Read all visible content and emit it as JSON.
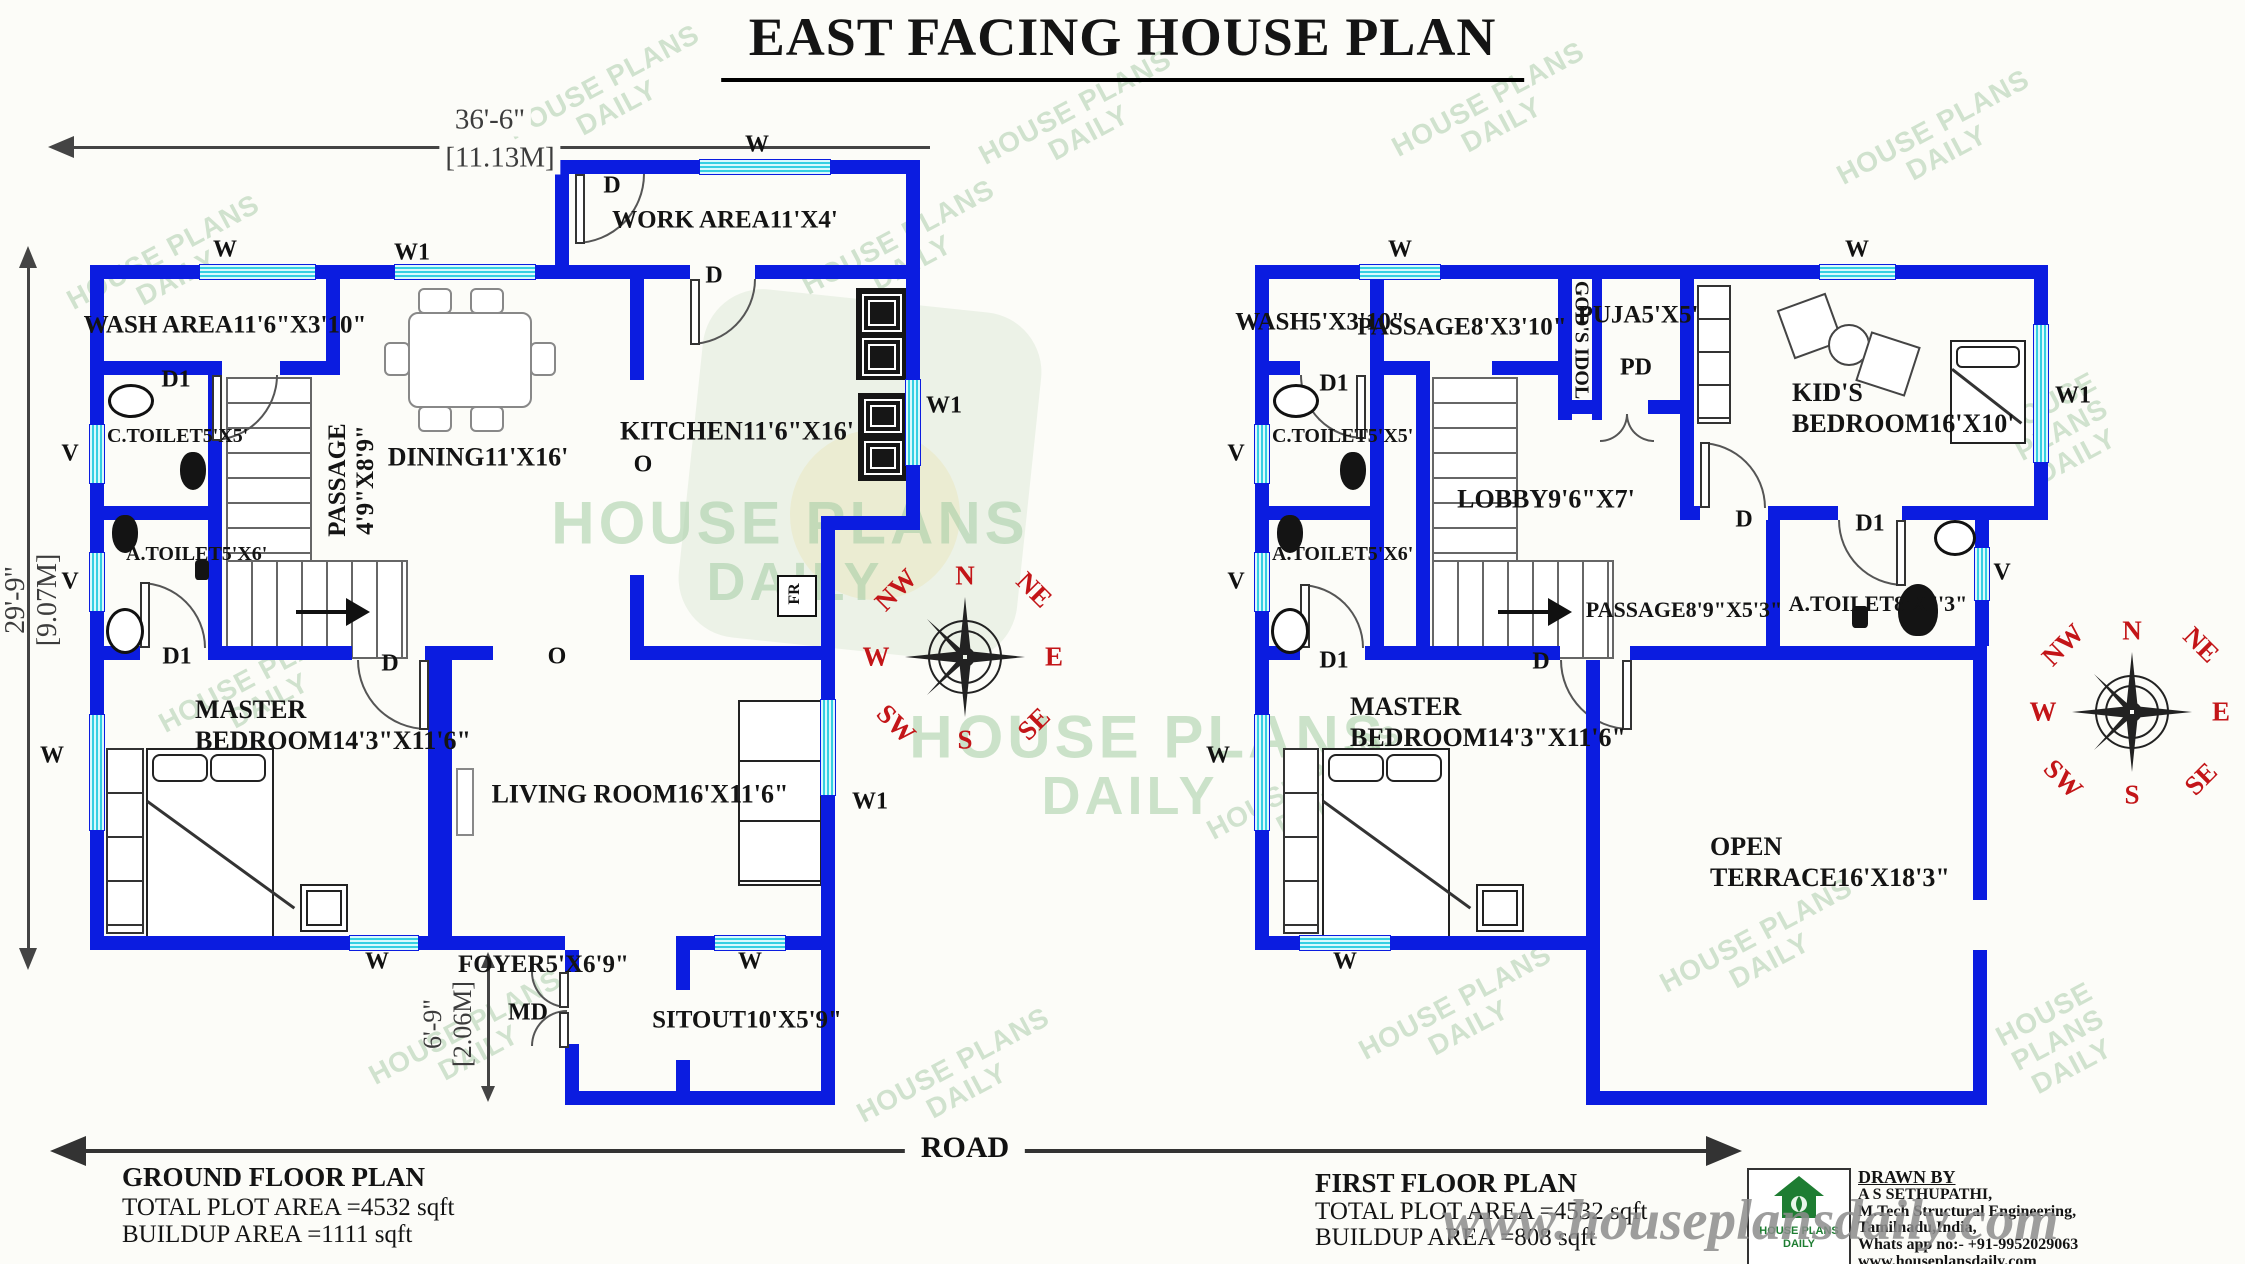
{
  "title": "EAST FACING HOUSE PLAN",
  "road_label": "ROAD",
  "watermark": {
    "site": "www.houseplansdaily.com",
    "brand_line1": "HOUSE PLANS",
    "brand_line2": "DAILY"
  },
  "markers": {
    "window": "W",
    "window1": "W1",
    "door": "D",
    "door1": "D1",
    "vent": "V",
    "opening": "O",
    "main_door": "MD",
    "puja_door": "PD",
    "fridge": "FR"
  },
  "dimensions": {
    "width_ft": "36'-6\"",
    "width_m": "[11.13M]",
    "height_ft": "29'-9\"",
    "height_m": "[9.07M]",
    "foyer_ft": "6'-9\"",
    "foyer_m": "[2.06M]"
  },
  "compass": {
    "n": "N",
    "ne": "NE",
    "e": "E",
    "se": "SE",
    "s": "S",
    "sw": "SW",
    "w": "W",
    "nw": "NW"
  },
  "ground_floor": {
    "rooms": {
      "work_area": {
        "name": "WORK AREA",
        "size": "11'X4'"
      },
      "wash_area": {
        "name": "WASH AREA",
        "size": "11'6\"X3'10\""
      },
      "c_toilet": {
        "name": "C.TOILET",
        "size": "5'X5'"
      },
      "a_toilet": {
        "name": "A.TOILET",
        "size": "5'X6'"
      },
      "passage": {
        "name": "PASSAGE",
        "size": "4'9\"X8'9\""
      },
      "dining": {
        "name": "DINING",
        "size": "11'X16'"
      },
      "kitchen": {
        "name": "KITCHEN",
        "size": "11'6\"X16'"
      },
      "master_bedroom": {
        "name": "MASTER BEDROOM",
        "size": "14'3\"X11'6\""
      },
      "living_room": {
        "name": "LIVING ROOM",
        "size": "16'X11'6\""
      },
      "foyer": {
        "name": "FOYER",
        "size": "5'X6'9\""
      },
      "sitout": {
        "name": "SITOUT",
        "size": "10'X5'9\""
      }
    },
    "footer": {
      "title": "GROUND FLOOR PLAN",
      "plot_area": "TOTAL PLOT AREA =4532 sqft",
      "buildup_area": "BUILDUP AREA =1111 sqft"
    }
  },
  "first_floor": {
    "rooms": {
      "wash": {
        "name": "WASH",
        "size": "5'X3'10\""
      },
      "passage_upper": {
        "name": "PASSAGE",
        "size": "8'X3'10\""
      },
      "gods_idol": {
        "name": "GOD'S IDOL"
      },
      "puja": {
        "name": "PUJA",
        "size": "5'X5'"
      },
      "kids_bedroom": {
        "name": "KID'S BEDROOM",
        "size": "16'X10'"
      },
      "c_toilet": {
        "name": "C.TOILET",
        "size": "5'X5'"
      },
      "a_toilet": {
        "name": "A.TOILET",
        "size": "5'X6'"
      },
      "lobby": {
        "name": "LOBBY",
        "size": "9'6\"X7'"
      },
      "passage_lower": {
        "name": "PASSAGE",
        "size": "8'9\"X5'3\""
      },
      "a_toilet2": {
        "name": "A.TOILET",
        "size": "8'X5'3\""
      },
      "master_bedroom": {
        "name": "MASTER BEDROOM",
        "size": "14'3\"X11'6\""
      },
      "open_terrace": {
        "name": "OPEN TERRACE",
        "size": "16'X18'3\""
      }
    },
    "footer": {
      "title": "FIRST FLOOR PLAN",
      "plot_area": "TOTAL PLOT AREA =4532 sqft",
      "buildup_area": "BUILDUP AREA =808 sqft"
    }
  },
  "drawn_by": {
    "heading": "DRAWN BY",
    "name": "A S SETHUPATHI,",
    "qualification": "M.Tech Structural Engineering,",
    "location": "Tamilnadu,India,",
    "whatsapp": "Whats app no:- +91-9952029063",
    "website": "www.houseplansdaily.com"
  },
  "colors": {
    "wall": "#0b1ce0",
    "window": "#35cfe2",
    "compass_label": "#c31518",
    "watermark_green": "#9cc49c"
  }
}
